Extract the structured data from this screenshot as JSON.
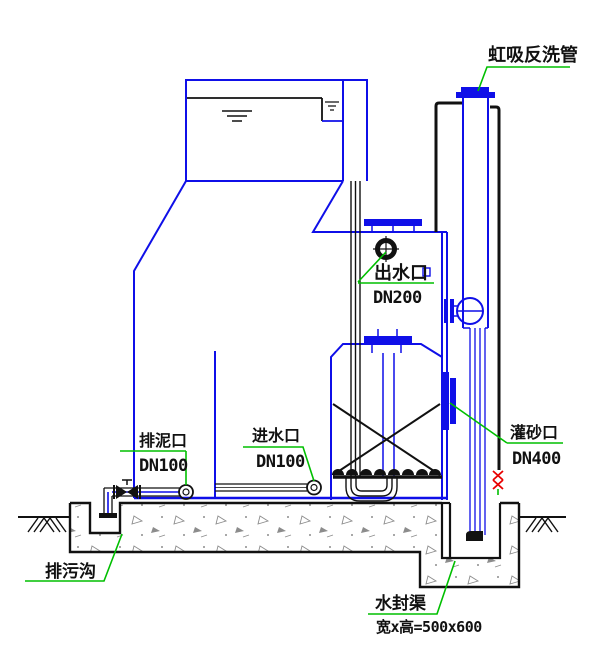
{
  "diagram": {
    "type": "engineering-section-drawing",
    "subject": "valveless gravity filter tank cross-section",
    "labels": {
      "siphon_backwash_pipe": "虹吸反洗管",
      "outlet_name": "出水口",
      "outlet_size": "DN200",
      "mud_drain_name": "排泥口",
      "mud_drain_size": "DN100",
      "inlet_name": "进水口",
      "inlet_size": "DN100",
      "sand_fill_name": "灌砂口",
      "sand_fill_size": "DN400",
      "sewage_ditch": "排污沟",
      "water_seal_name": "水封渠",
      "water_seal_dimension": "宽x高=500x600"
    },
    "colors": {
      "outline_blue": "#0f0fe8",
      "line_black": "#111111",
      "leader_green": "#00bf00",
      "valve_red": "#e80000",
      "concrete_gray": "#8c8c8c"
    }
  }
}
